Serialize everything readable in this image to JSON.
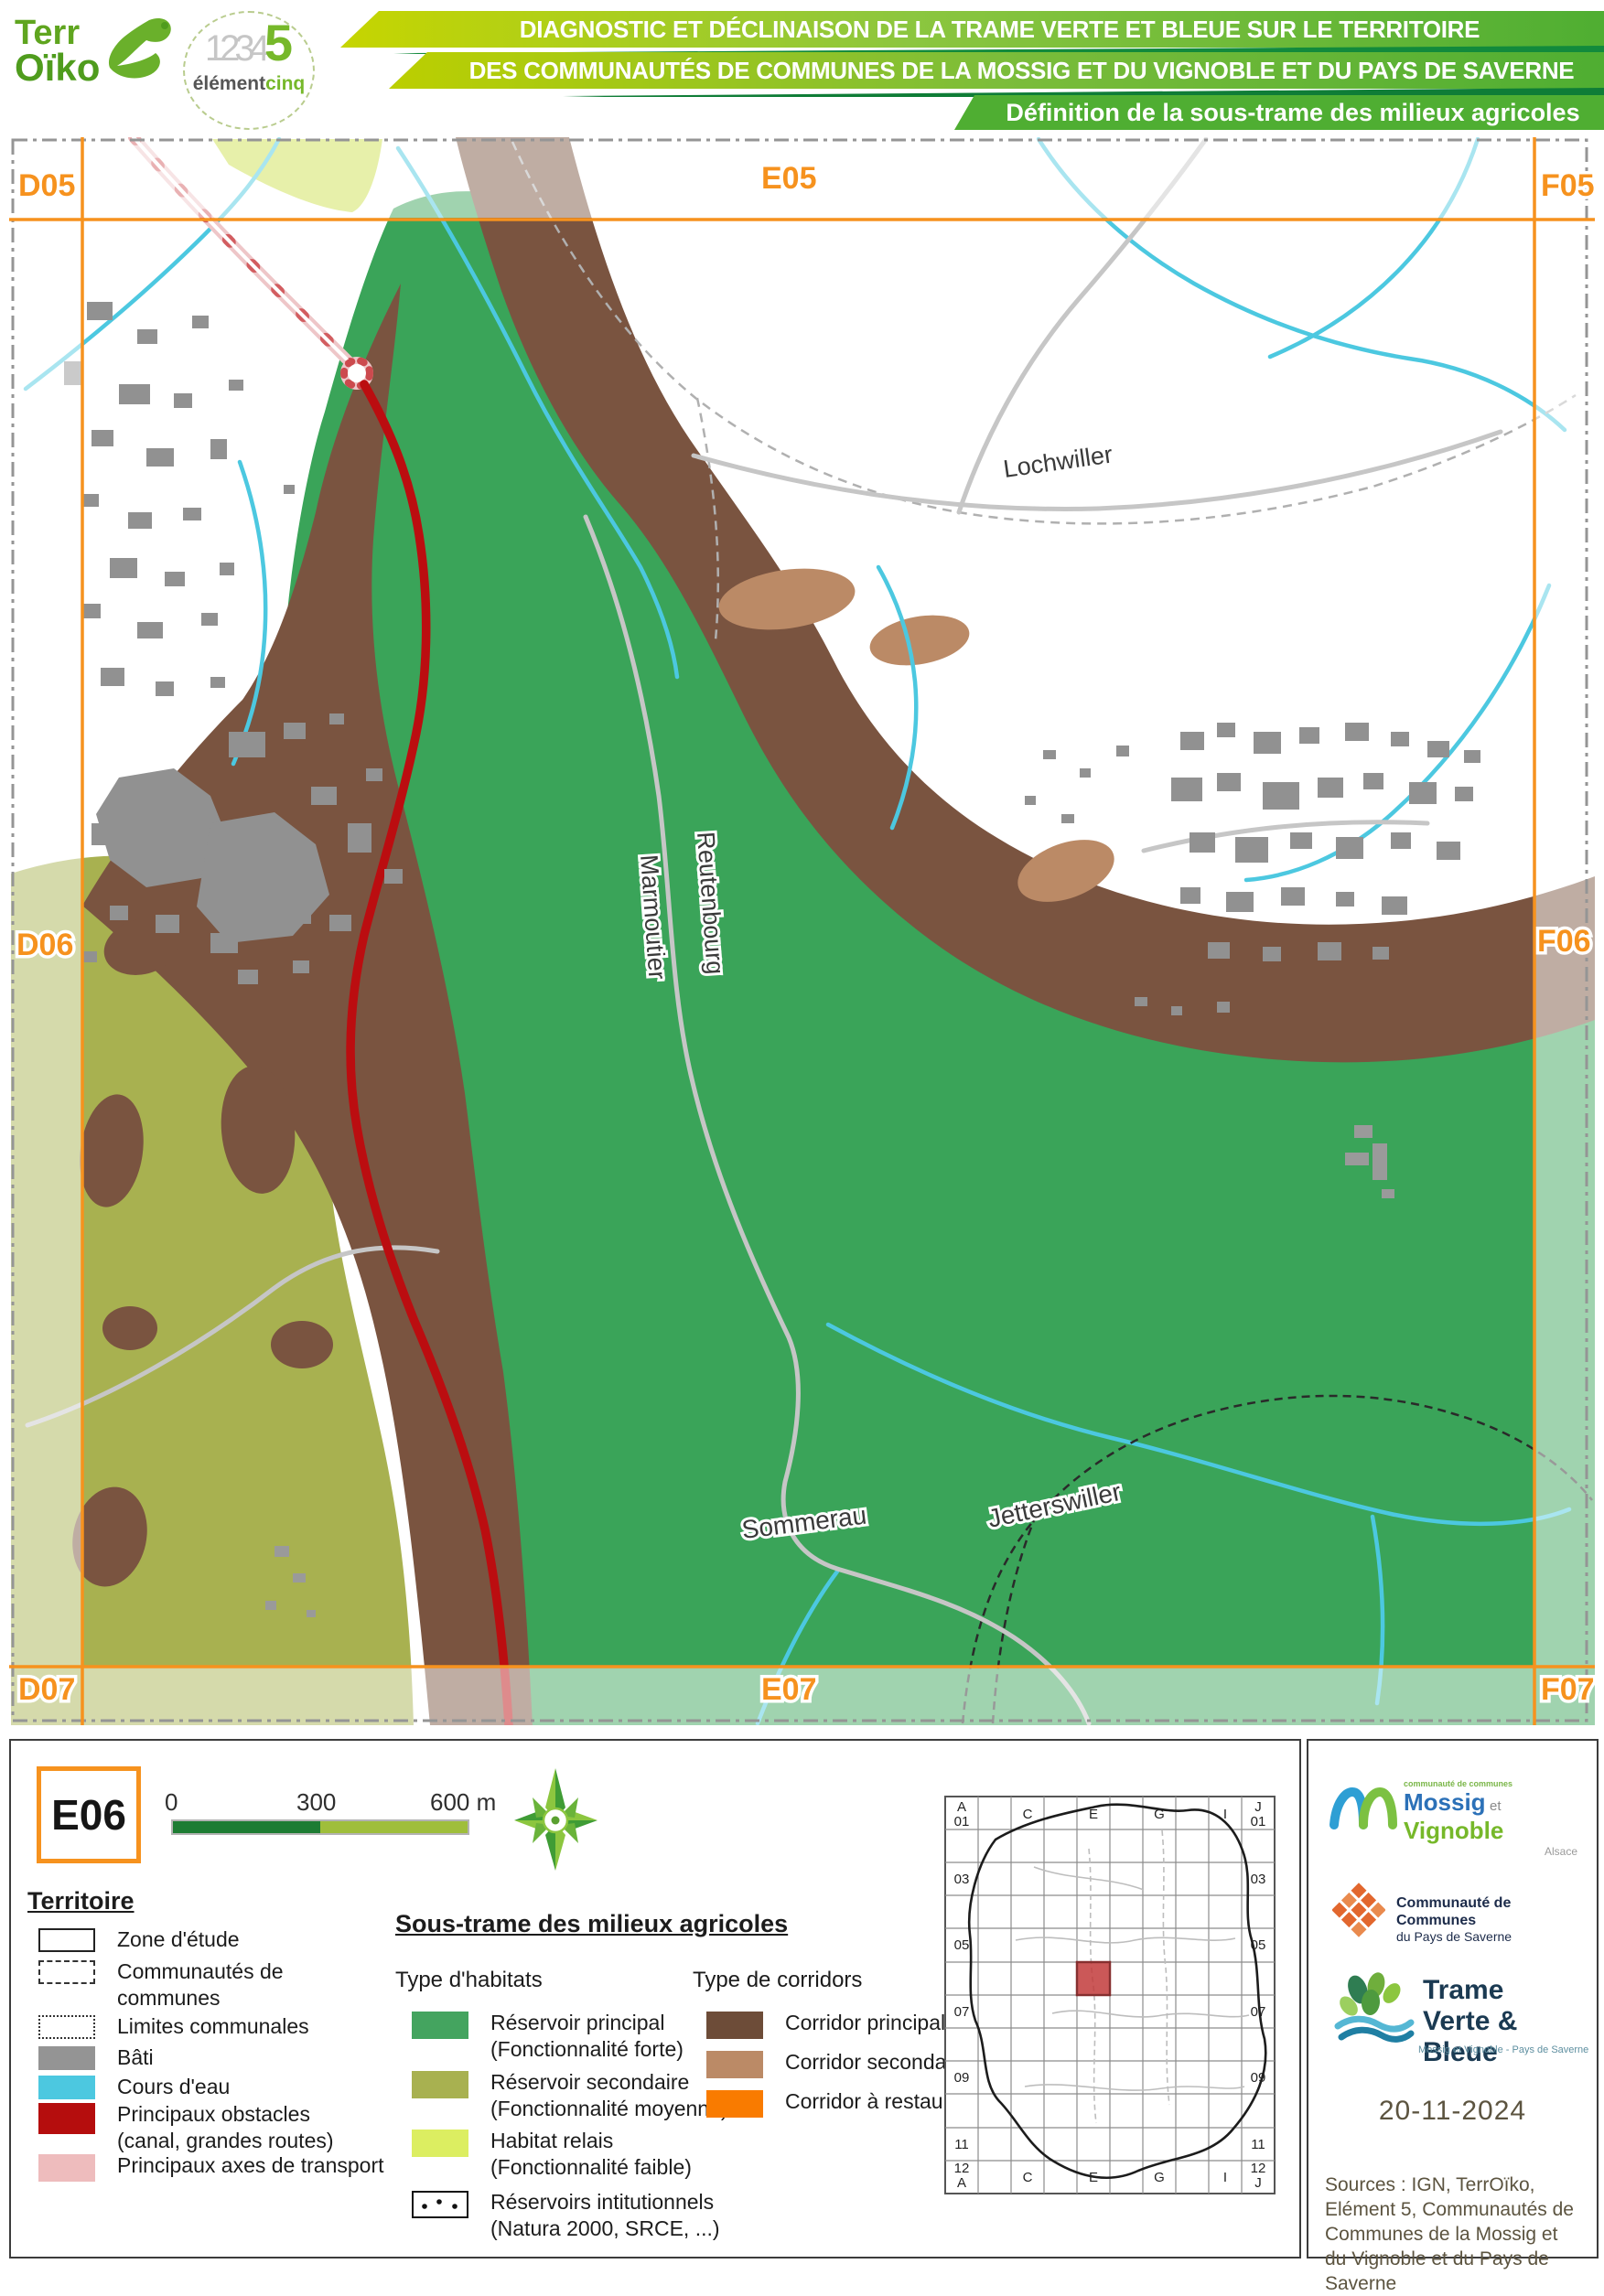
{
  "header": {
    "terroiko": {
      "line1": "Terr",
      "line2": "Oïko"
    },
    "elementcinq": {
      "numbers": "1234",
      "five": "5",
      "word1": "élément",
      "word2": "cinq"
    },
    "banner1": "DIAGNOSTIC ET DÉCLINAISON DE LA TRAME VERTE ET BLEUE SUR LE TERRITOIRE",
    "banner2": "DES COMMUNAUTÉS DE COMMUNES DE LA MOSSIG ET DU VIGNOBLE ET DU PAYS DE SAVERNE",
    "banner3": "Définition de la sous-trame des milieux agricoles"
  },
  "map": {
    "grid_labels": [
      "D05",
      "E05",
      "F05",
      "D06",
      "F06",
      "D07",
      "E07",
      "F07"
    ],
    "towns": [
      "Lochwiller",
      "Marmoutier",
      "Reutenbourg",
      "Sommerau",
      "Jetterswiller"
    ]
  },
  "legend": {
    "tile_code": "E06",
    "scalebar": {
      "start": "0",
      "mid": "300",
      "end": "600 m"
    },
    "territoire": {
      "title": "Territoire",
      "items": [
        "Zone d'étude",
        "Communautés de communes",
        "Limites communales",
        "Bâti",
        "Cours d'eau",
        "Principaux obstacles (canal, grandes routes)",
        "Principaux axes de transport"
      ]
    },
    "soustrame": {
      "title": "Sous-trame des milieux agricoles",
      "habitats": {
        "title": "Type d'habitats",
        "items": [
          "Réservoir principal (Fonctionnalité forte)",
          "Réservoir secondaire (Fonctionnalité moyenne)",
          "Habitat relais (Fonctionnalité faible)",
          "Réservoirs intitutionnels (Natura 2000, SRCE, ...)"
        ]
      },
      "corridors": {
        "title": "Type de corridors",
        "items": [
          "Corridor principal",
          "Corridor secondaire",
          "Corridor à restaurer"
        ]
      }
    }
  },
  "minimap": {
    "labels": [
      "A",
      "01",
      "C",
      "E",
      "G",
      "I",
      "J",
      "01",
      "03",
      "05",
      "07",
      "09",
      "11",
      "12",
      "A",
      "03",
      "05",
      "07",
      "09",
      "11",
      "12",
      "J",
      "C",
      "E",
      "G",
      "I"
    ]
  },
  "credits": {
    "mossig": {
      "small": "communauté de communes",
      "name1": "Mossig",
      "et": "et",
      "name2": "Vignoble",
      "region": "Alsace"
    },
    "saverne": {
      "line1": "Communauté de Communes",
      "line2": "du Pays de Saverne"
    },
    "tvb": {
      "line1": "Trame",
      "line2": "Verte & Bleue",
      "sub": "Mossig et Vignoble - Pays de Saverne"
    },
    "date": "20-11-2024",
    "sources": "Sources : IGN, TerrOïko, Elément 5, Communautés de Communes de la Mossig et du Vignoble et du Pays de Saverne"
  },
  "colors": {
    "accent_orange": "#F6921E",
    "banner_green": "#4FAE32",
    "banner_yellow_green": "#C6D500",
    "reservoir_principal": "#3AA459",
    "reservoir_secondaire": "#A8B150",
    "habitat_relais": "#DCEE61",
    "corridor_principal": "#7A5440",
    "corridor_secondaire": "#BB8A66",
    "corridor_restaurer": "#F97B00",
    "cours_eau": "#4CC8E0",
    "bati": "#949494",
    "obstacle_rouge": "#BB0D10",
    "axe_transport_rose": "#EEBCBD"
  }
}
